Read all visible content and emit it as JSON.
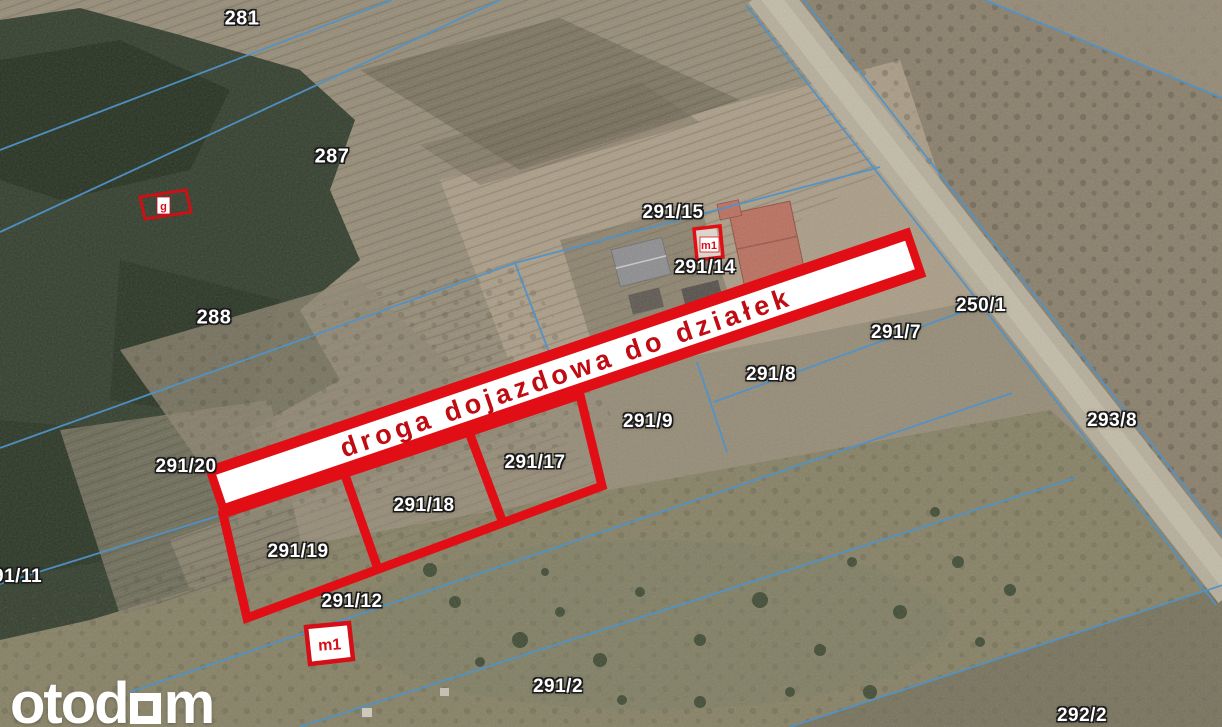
{
  "road_label": "droga dojazdowa do działek",
  "watermark": {
    "prefix": "otod",
    "suffix": "m"
  },
  "markers": {
    "house_label": "m1",
    "bottom_label": "m1",
    "forest_label": "g"
  },
  "parcels": [
    {
      "label": "281"
    },
    {
      "label": "287"
    },
    {
      "label": "288"
    },
    {
      "label": "291/15"
    },
    {
      "label": "291/14"
    },
    {
      "label": "250/1"
    },
    {
      "label": "291/7"
    },
    {
      "label": "291/8"
    },
    {
      "label": "291/9"
    },
    {
      "label": "293/8"
    },
    {
      "label": "291/20"
    },
    {
      "label": "291/17"
    },
    {
      "label": "291/18"
    },
    {
      "label": "291/19"
    },
    {
      "label": "291/12"
    },
    {
      "label": "291/11"
    },
    {
      "label": "291/2"
    },
    {
      "label": "292/2"
    }
  ],
  "colors": {
    "overlay_red": "#e10f15",
    "band_text_red": "#c00b12",
    "cadastral_blue": "#4f93c9",
    "label_text": "#ffffff"
  }
}
